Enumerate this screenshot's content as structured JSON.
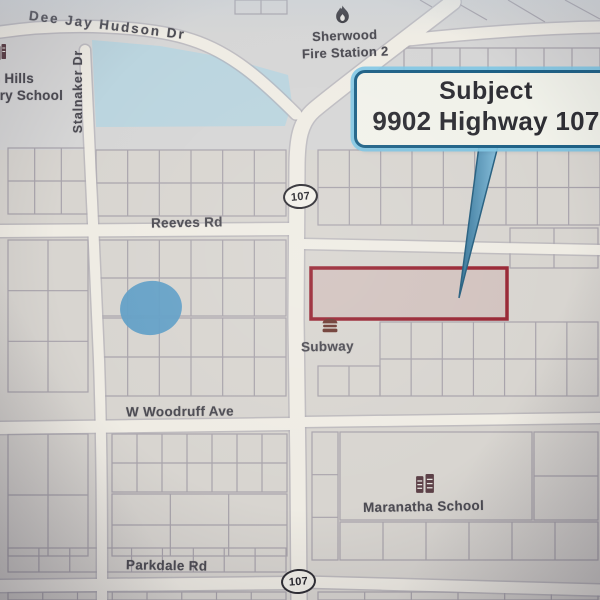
{
  "labels": {
    "dee_jay": "Dee Jay Hudson Dr",
    "school_left_line1": "n Hills",
    "school_left_line2": "ary School",
    "stalnaker": "Stalnaker Dr",
    "fire_line1": "Sherwood",
    "fire_line2": "Fire Station 2",
    "shield_top": "107",
    "shield_bottom": "107",
    "reeves": "Reeves Rd",
    "subway": "Subway",
    "woodruff": "W Woodruff Ave",
    "maranatha": "Maranatha School",
    "parkdale": "Parkdale Rd"
  },
  "callout": {
    "line1": "Subject",
    "line2": "9902 Highway 107"
  },
  "map": {
    "colors": {
      "paper": "#d8d5d0",
      "parcel_line": "#a39ea7",
      "road_fill": "#efece4",
      "road_casing": "#aeaab3",
      "water_light": "#b7d5e1",
      "water_dark": "#5f9fc8",
      "subject_border": "#9c2433",
      "subject_fill": "rgba(156,36,51,0.10)",
      "pointer_dark": "#2f7096",
      "pointer_light": "#84bedd",
      "pointer_stroke": "#235e80"
    },
    "geometry": {
      "parcel_strips": [
        [
          8,
          148,
          80,
          66,
          3,
          2
        ],
        [
          96,
          150,
          190,
          66,
          6,
          2
        ],
        [
          8,
          240,
          80,
          152,
          2,
          3
        ],
        [
          96,
          240,
          190,
          76,
          6,
          2
        ],
        [
          96,
          318,
          190,
          78,
          6,
          2
        ],
        [
          8,
          434,
          80,
          122,
          2,
          2
        ],
        [
          112,
          434,
          175,
          58,
          7,
          2
        ],
        [
          112,
          494,
          175,
          62,
          3,
          2
        ],
        [
          8,
          548,
          278,
          24,
          9,
          1
        ],
        [
          8,
          592,
          278,
          8,
          8,
          1
        ],
        [
          235,
          0,
          52,
          14,
          2,
          1
        ],
        [
          404,
          48,
          196,
          62,
          7,
          1
        ],
        [
          318,
          150,
          282,
          75,
          9,
          2
        ],
        [
          510,
          228,
          88,
          40,
          2,
          1
        ],
        [
          380,
          322,
          218,
          74,
          7,
          2
        ],
        [
          318,
          366,
          62,
          30,
          2,
          1
        ],
        [
          340,
          432,
          192,
          88,
          1,
          1
        ],
        [
          534,
          432,
          64,
          88,
          1,
          2
        ],
        [
          312,
          432,
          26,
          128,
          1,
          3
        ],
        [
          340,
          522,
          258,
          38,
          6,
          1
        ],
        [
          318,
          592,
          280,
          8,
          6,
          1
        ]
      ],
      "diagonals": [
        [
          452,
          0,
          487,
          20
        ],
        [
          508,
          0,
          545,
          22
        ],
        [
          565,
          0,
          600,
          19
        ],
        [
          420,
          0,
          432,
          7
        ]
      ],
      "water_polygon": "92,40 160,46 228,58 288,75 292,103 285,126 96,127",
      "small_pond": {
        "cx": 151,
        "cy": 308,
        "rx": 31,
        "ry": 27,
        "rot": -8
      },
      "roads": [
        {
          "d": "M 0 32 C 70 22 150 26 192 40 C 232 53 262 80 296 114",
          "w": 11
        },
        {
          "d": "M 85 50 C 89 140 95 260 99 360 C 102 450 102 520 102 600",
          "w": 10
        },
        {
          "d": "M 408 40 C 470 33 545 28 600 27",
          "w": 11
        },
        {
          "d": "M 0 231 L 291 229",
          "w": 12
        },
        {
          "d": "M 303 244 L 600 250",
          "w": 10
        },
        {
          "d": "M 0 428 L 292 424",
          "w": 12
        },
        {
          "d": "M 303 422 L 600 418",
          "w": 10
        },
        {
          "d": "M 0 586 L 292 583",
          "w": 12
        },
        {
          "d": "M 303 582 L 600 590",
          "w": 11
        },
        {
          "d": "M 453 2 C 420 28 340 88 314 110 C 300 122 297 140 297 168 L 296 320 L 298 470 L 299 600",
          "w": 15
        }
      ],
      "subject_parcel": {
        "x": 311,
        "y": 268,
        "w": 196,
        "h": 51
      },
      "pointer": "479,146 498,146 459,298"
    }
  }
}
